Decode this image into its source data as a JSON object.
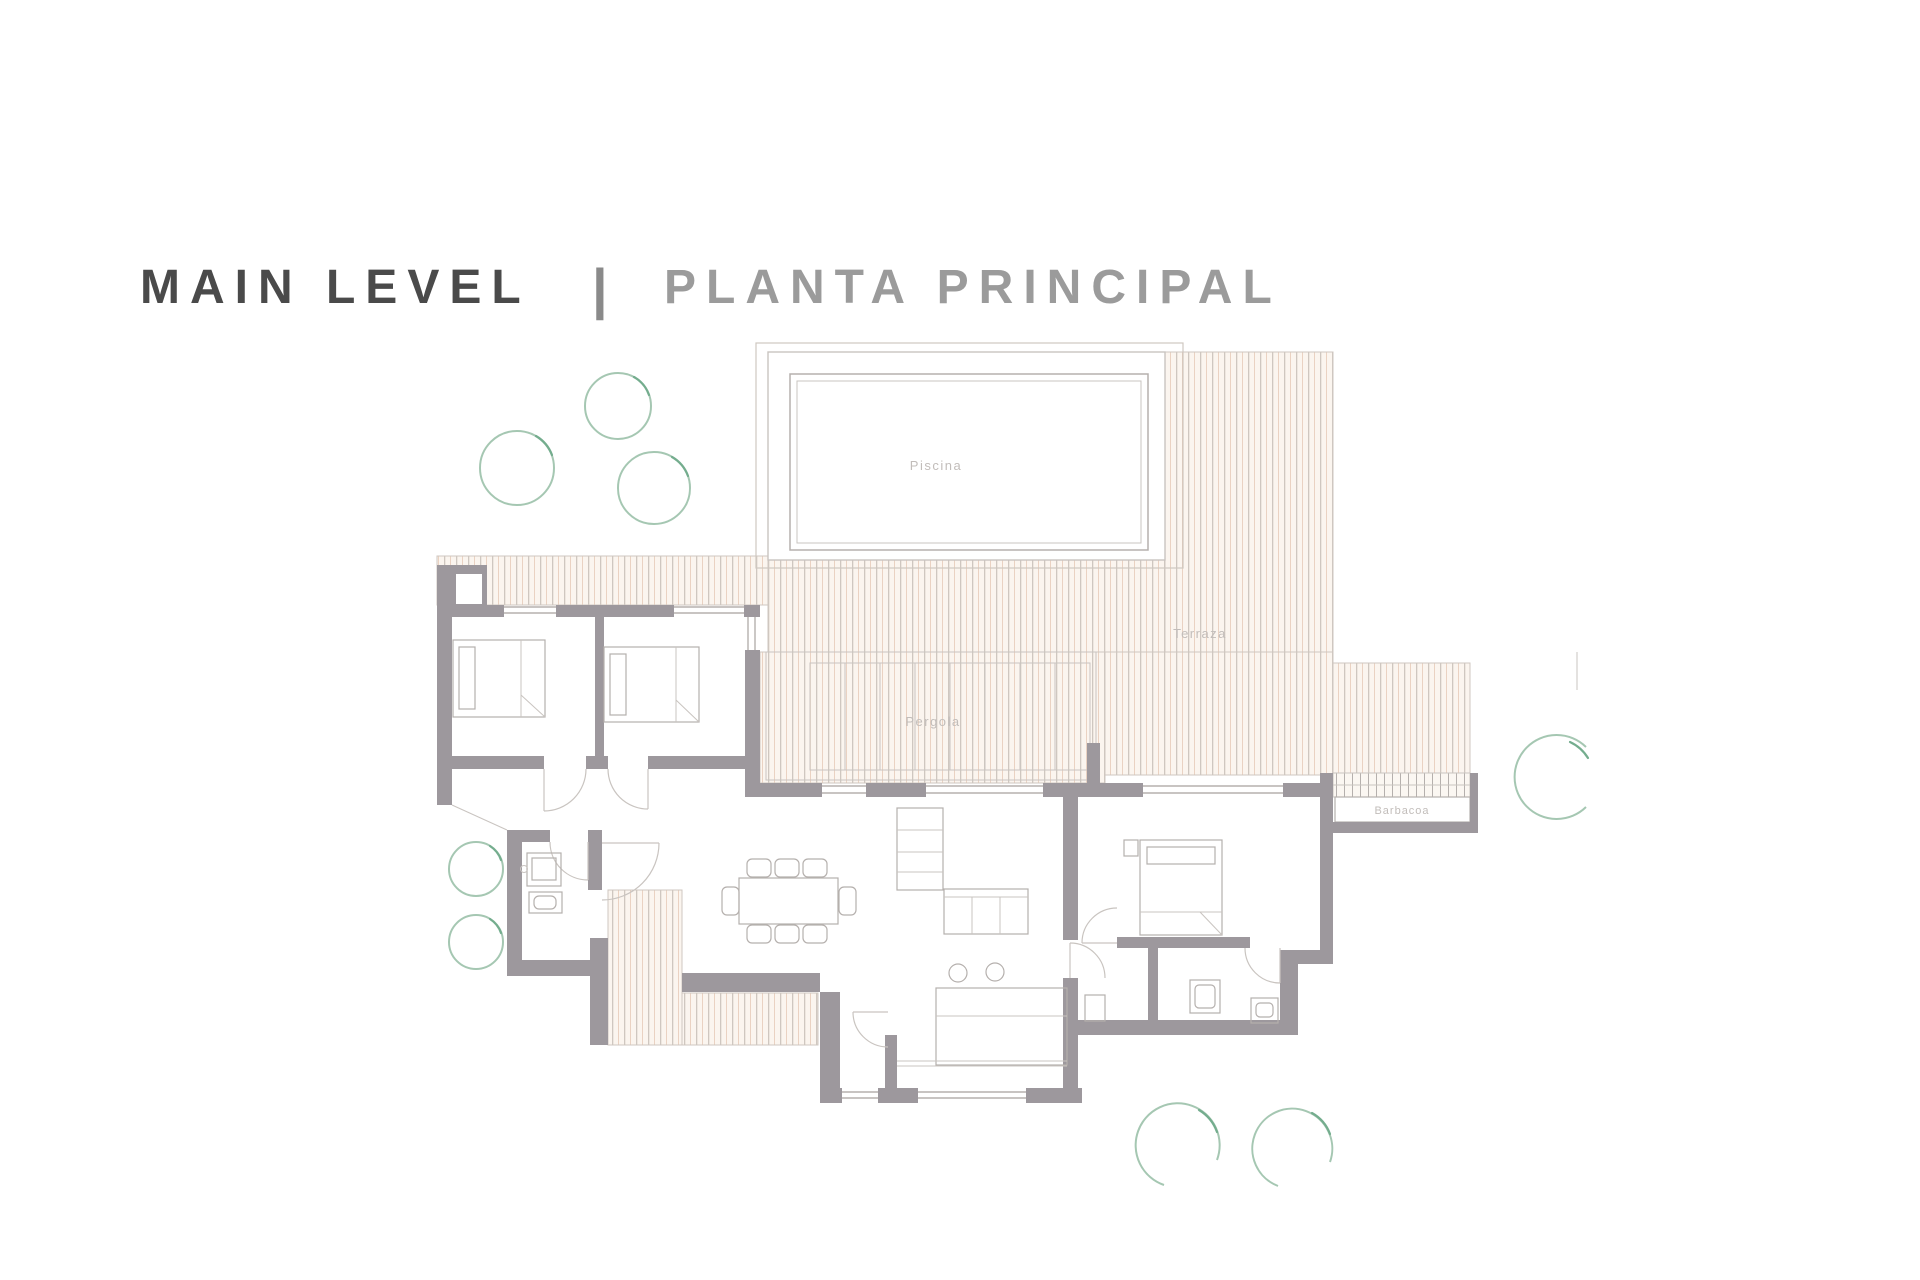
{
  "title": {
    "main": "MAIN LEVEL",
    "divider": "|",
    "secondary": "PLANTA PRINCIPAL"
  },
  "rooms": {
    "pool": "Piscina",
    "terrace": "Terraza",
    "pergola": "Pergola",
    "barbecue": "Barbacoa"
  },
  "colors": {
    "title_main": "#4a4a4a",
    "title_divider": "#8a8a8a",
    "title_secondary": "#9b9b9b",
    "wall": "#9d989d",
    "line": "#b5b0ad",
    "line_light": "#c9c4c0",
    "deck_bg": "#fbf5ef",
    "deck_line": "#cfc7c0",
    "deck_accent": "#e6cab7",
    "label_text": "#c2bdba",
    "tree": "#a5c7b2",
    "tree_accent": "#74ad8e"
  }
}
